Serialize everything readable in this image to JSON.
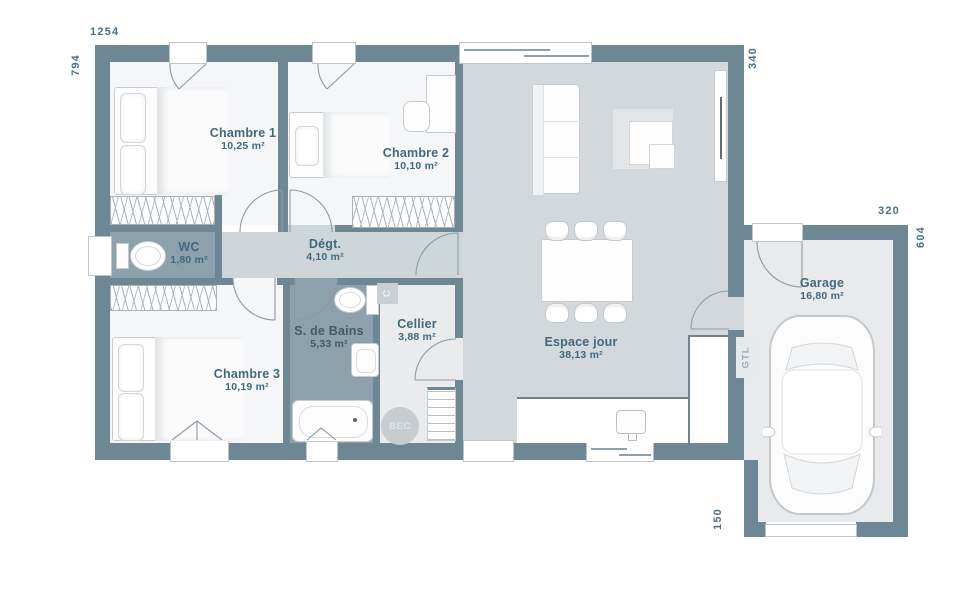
{
  "rooms": [
    {
      "id": "chambre1",
      "name": "Chambre 1",
      "area": "10,25 m²"
    },
    {
      "id": "chambre2",
      "name": "Chambre 2",
      "area": "10,10 m²"
    },
    {
      "id": "wc",
      "name": "WC",
      "area": "1,80 m²"
    },
    {
      "id": "degagement",
      "name": "Dégt.",
      "area": "4,10 m²"
    },
    {
      "id": "chambre3",
      "name": "Chambre 3",
      "area": "10,19 m²"
    },
    {
      "id": "salle_de_bains",
      "name": "S. de Bains",
      "area": "5,33 m²"
    },
    {
      "id": "cellier",
      "name": "Cellier",
      "area": "3,88 m²"
    },
    {
      "id": "espace_jour",
      "name": "Espace jour",
      "area": "38,13 m²"
    },
    {
      "id": "garage",
      "name": "Garage",
      "area": "16,80 m²"
    }
  ],
  "dimensions_cm": {
    "house_width": "1254",
    "house_depth": "794",
    "house_right_side": "340",
    "garage_width": "320",
    "garage_depth": "604",
    "garage_offset": "150"
  },
  "annotations": {
    "gtl": "GTL",
    "water_heater": "BEC",
    "boiler": "C"
  },
  "colors": {
    "wall": "#6E8795",
    "floor_bedroom": "#F5F6F7",
    "floor_living": "#D3D8DC",
    "floor_wet": "#8DA1AC",
    "floor_utility": "#E9EBEC",
    "label_text": "#40697E"
  }
}
